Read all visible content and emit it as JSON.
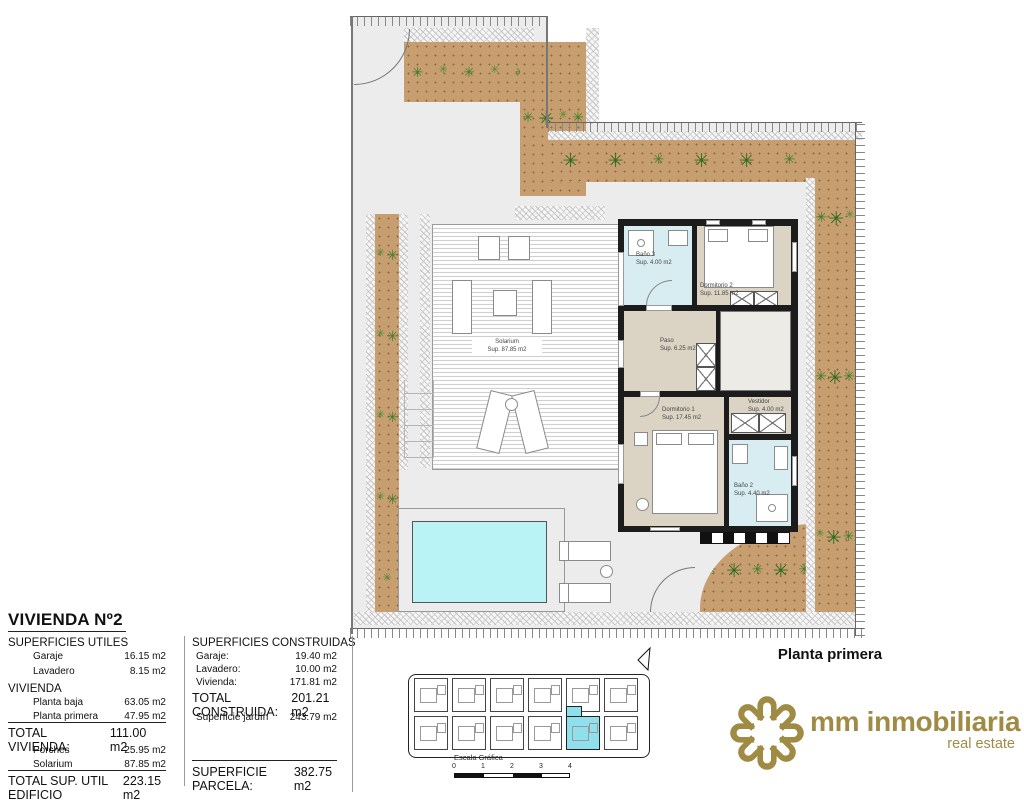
{
  "plan": {
    "floor_label": "Planta primera",
    "rooms": {
      "bano3": {
        "name": "Baño 3",
        "area": "Sup. 4.00 m2"
      },
      "dormitorio2": {
        "name": "Dormitorio 2",
        "area": "Sup. 11.85 m2"
      },
      "paso": {
        "name": "Paso",
        "area": "Sup. 6.25 m2"
      },
      "dormitorio1": {
        "name": "Dormitorio 1",
        "area": "Sup. 17.45 m2"
      },
      "vestidor": {
        "name": "Vestidor",
        "area": "Sup. 4.00 m2"
      },
      "bano2": {
        "name": "Baño 2",
        "area": "Sup. 4.40 m2"
      },
      "solarium": {
        "name": "Solarium",
        "area": "Sup. 87.85 m2"
      }
    }
  },
  "summary": {
    "title": "VIVIENDA Nº2",
    "utiles": {
      "heading": "SUPERFICIES UTILES",
      "rows": [
        {
          "label": "Garaje",
          "value": "16.15 m2"
        },
        {
          "label": "Lavadero",
          "value": "8.15 m2"
        }
      ],
      "vivienda_heading": "VIVIENDA",
      "vivienda_rows": [
        {
          "label": "Planta baja",
          "value": "63.05 m2"
        },
        {
          "label": "Planta primera",
          "value": "47.95 m2"
        }
      ],
      "total_vivienda": {
        "label": "TOTAL VIVIENDA:",
        "value": "111.00 m2"
      },
      "extra_rows": [
        {
          "label": "Porches",
          "value": "25.95 m2"
        },
        {
          "label": "Solarium",
          "value": "87.85 m2"
        }
      ],
      "total_edificio": {
        "label": "TOTAL SUP. UTIL EDIFICIO",
        "value": "223.15 m2"
      }
    },
    "construidas": {
      "heading": "SUPERFICIES CONSTRUIDAS",
      "rows": [
        {
          "label": "Garaje:",
          "value": "19.40 m2"
        },
        {
          "label": "Lavadero:",
          "value": "10.00 m2"
        },
        {
          "label": "Vivienda:",
          "value": "171.81 m2"
        }
      ],
      "total": {
        "label": "TOTAL CONSTRUIDA:",
        "value": "201.21 m2"
      },
      "jardin": {
        "label": "Superficie jardín",
        "value": "243.79 m2"
      },
      "parcela": {
        "label": "SUPERFICIE PARCELA:",
        "value": "382.75 m2"
      }
    }
  },
  "site_key": {
    "scale_label": "Escala Gráfica",
    "scale_ticks": [
      "0",
      "1",
      "2",
      "3",
      "4"
    ]
  },
  "brand": {
    "name": "mm inmobiliaria",
    "tagline": "real estate",
    "color": "#A08B45"
  },
  "colors": {
    "pool": "#B9F3F6",
    "bath_floor": "#D8EDF2",
    "room_floor": "#DBD3C3",
    "garden_bed": "#C79E6F",
    "site_highlight": "#8FE0EC",
    "brand_gold": "#A08B45"
  }
}
